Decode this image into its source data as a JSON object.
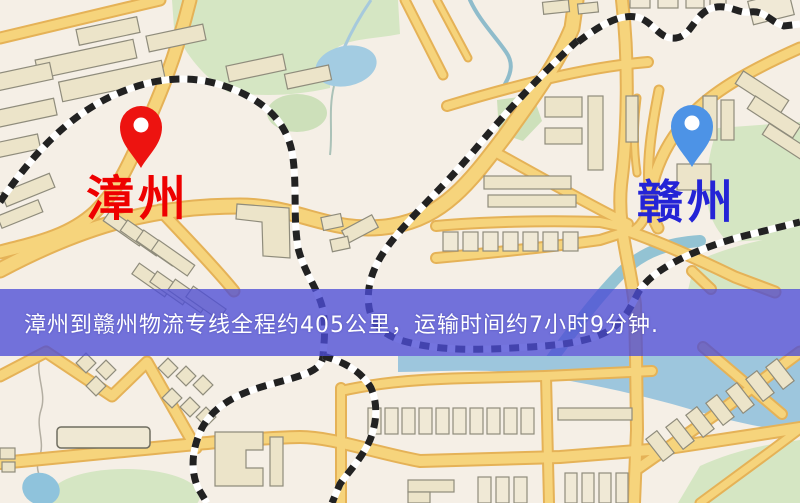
{
  "markers": {
    "origin": {
      "label": "漳州",
      "pin_icon": "red-location-pin",
      "pin_color": "#ed1310",
      "label_color": "#ee0000"
    },
    "destination": {
      "label": "赣州",
      "pin_icon": "blue-location-pin",
      "pin_color": "#4d93e6",
      "label_color": "#2424d6"
    }
  },
  "banner": {
    "text": "漳州到赣州物流专线全程约405公里，运输时间约7小时9分钟.",
    "background_color": "#4d4dd6",
    "text_color": "#ffffff",
    "distance_km": "405",
    "duration": "7小时9分钟"
  },
  "map_colors": {
    "background": "#f5efe6",
    "road_fill": "#f6d47c",
    "road_casing": "#e5b257",
    "railway": "#222222",
    "park_green": "#d5e6c3",
    "water_blue": "#a3cce2",
    "building_fill": "#ece4c9",
    "building_stroke": "#8f8c7c"
  }
}
